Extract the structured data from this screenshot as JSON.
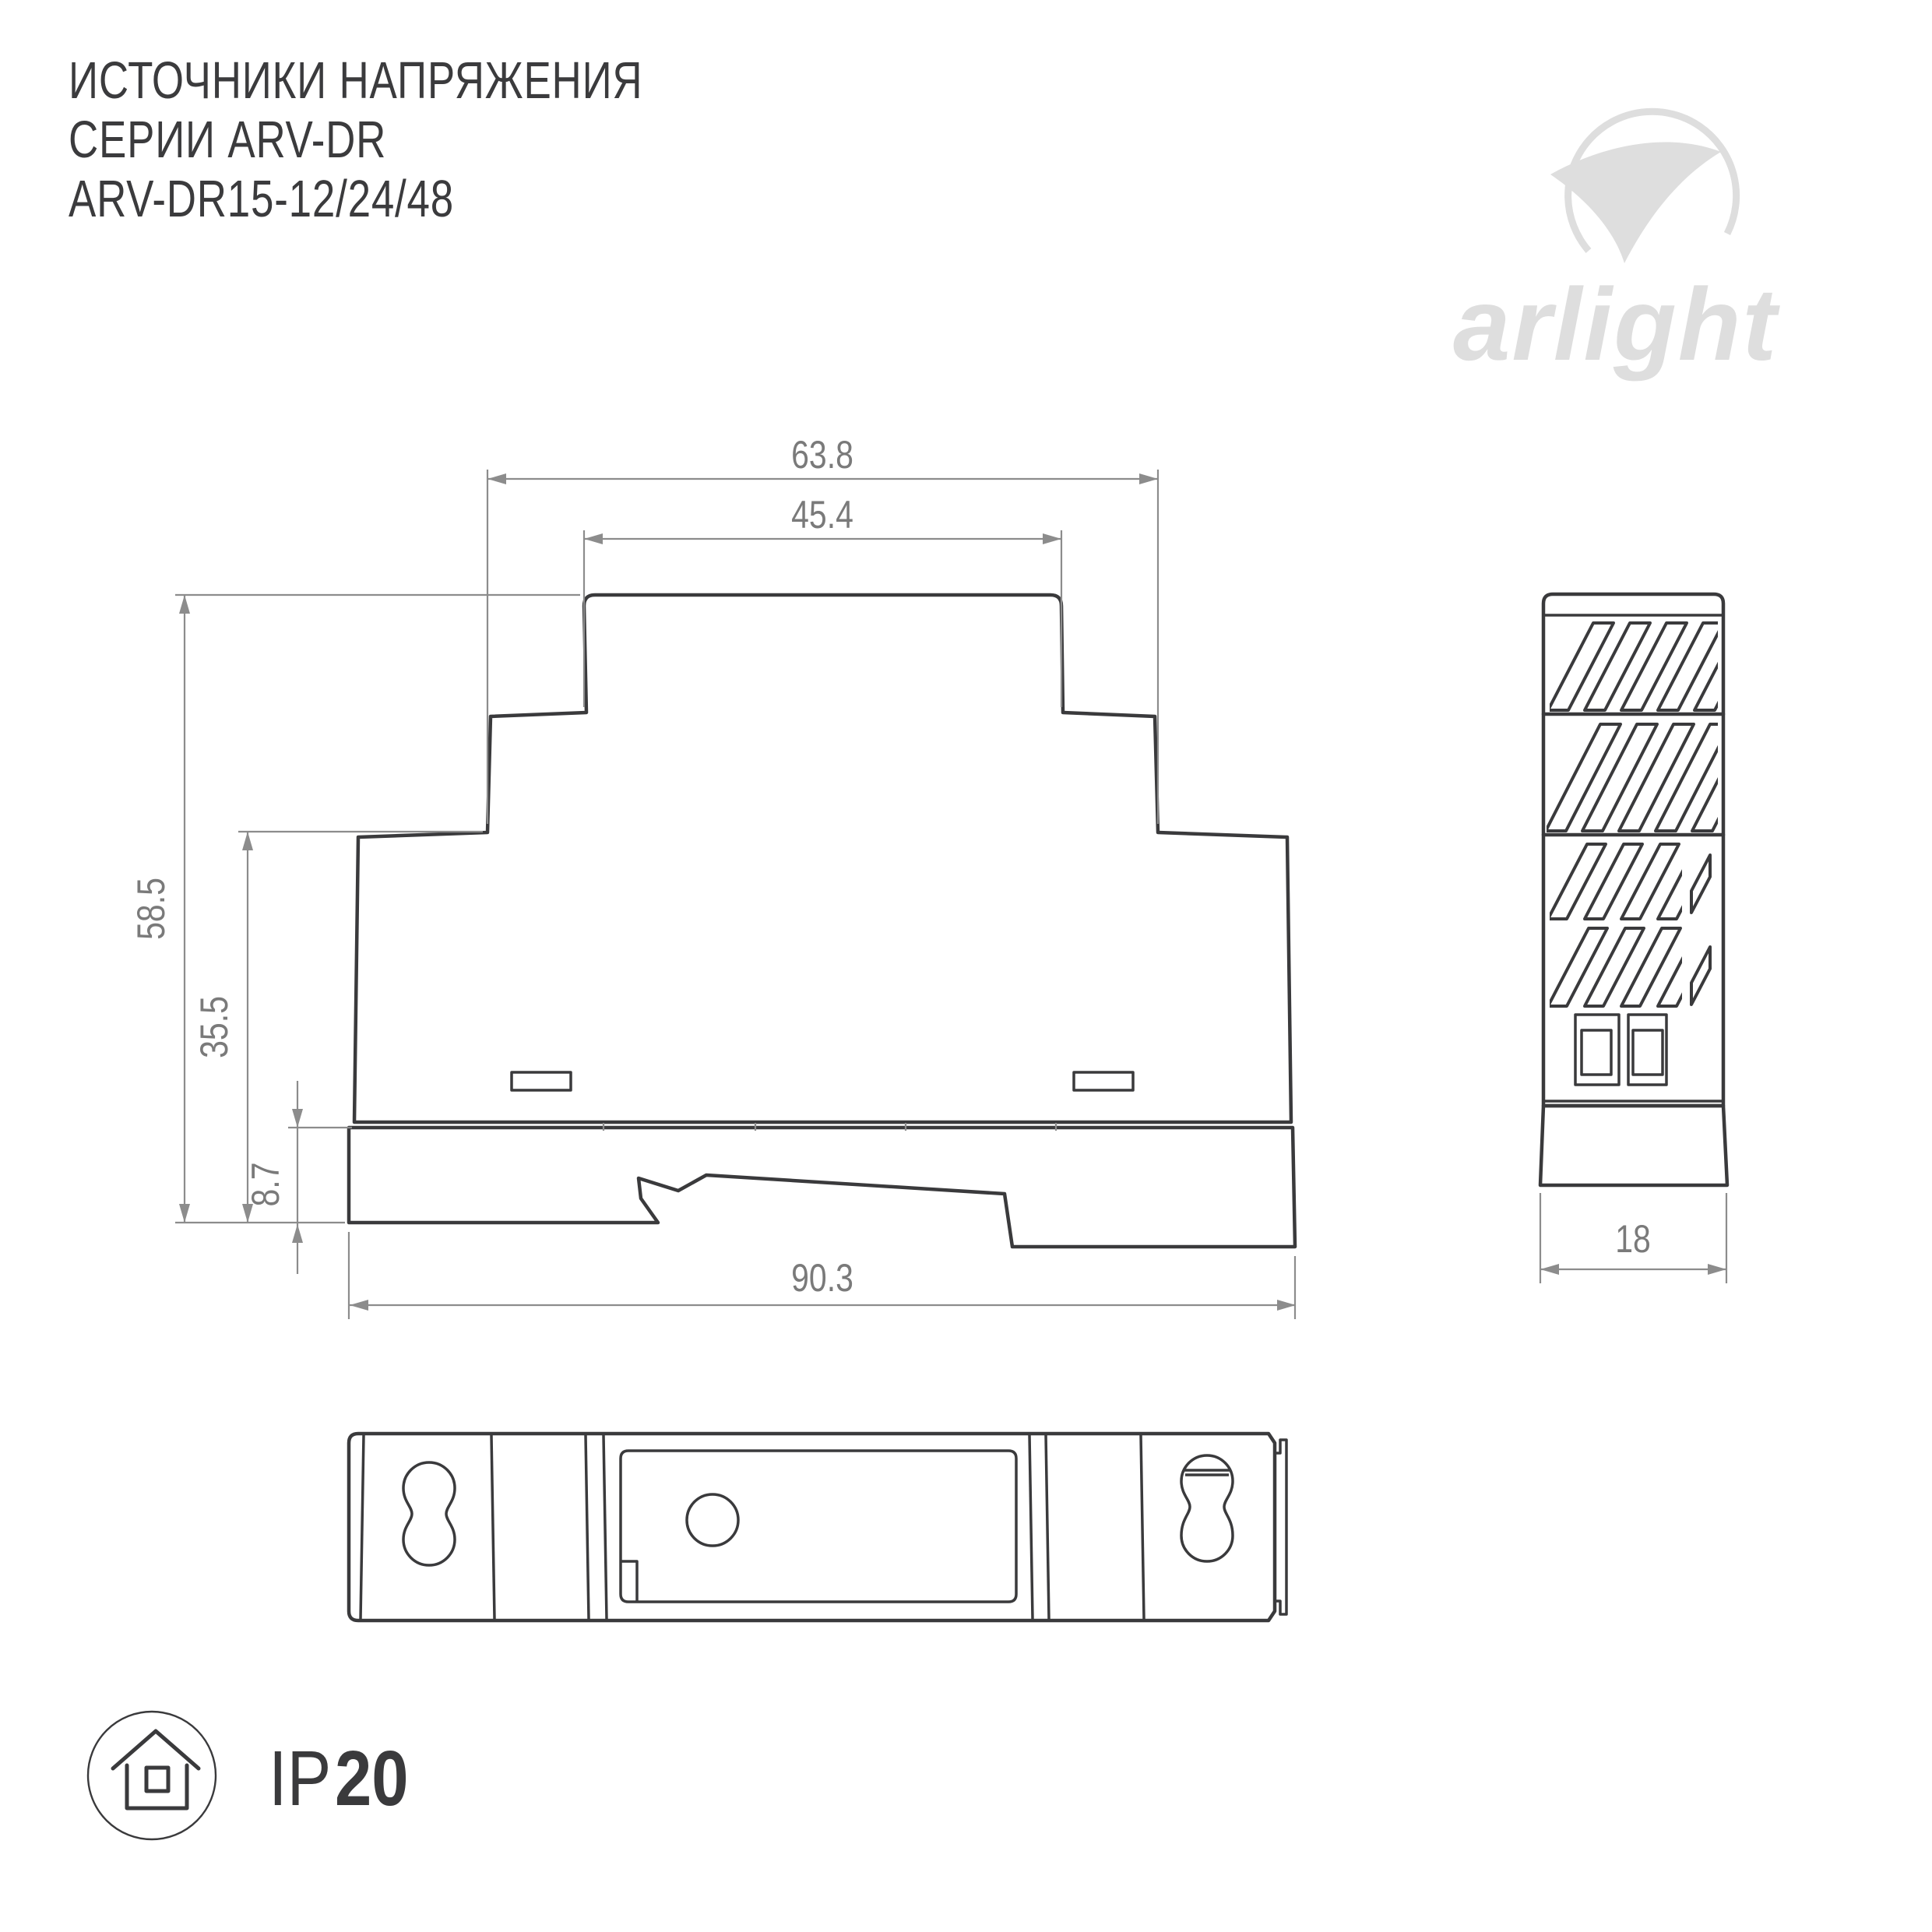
{
  "page": {
    "background": "#ffffff"
  },
  "header": {
    "title_line1": "ИСТОЧНИКИ НАПРЯЖЕНИЯ",
    "title_line2": "СЕРИИ ARV-DR",
    "title_line3": "ARV-DR15-12/24/48"
  },
  "brand": {
    "logo_text": "arlight",
    "logo_color": "#dedede",
    "mark": "swoosh-circle-icon"
  },
  "drawing": {
    "line_color": "#3a3a3c",
    "dimension_line_color": "#8c8c8c",
    "dimension_text_color": "#7a7a7a",
    "front_view": {
      "name": "front view of DIN-rail power supply",
      "dimensions": {
        "outer_top_width": "63.8",
        "cap_width": "45.4",
        "total_height": "58.5",
        "body_height": "35.5",
        "base_height": "8.7",
        "bottom_width": "90.3"
      }
    },
    "side_view": {
      "name": "side view with ventilation slots",
      "dimensions": {
        "depth": "18"
      }
    },
    "bottom_view": {
      "name": "bottom mounting view with keyhole slots"
    }
  },
  "protection_badge": {
    "prefix": "IP",
    "rating": "20",
    "icon": "house-icon"
  }
}
